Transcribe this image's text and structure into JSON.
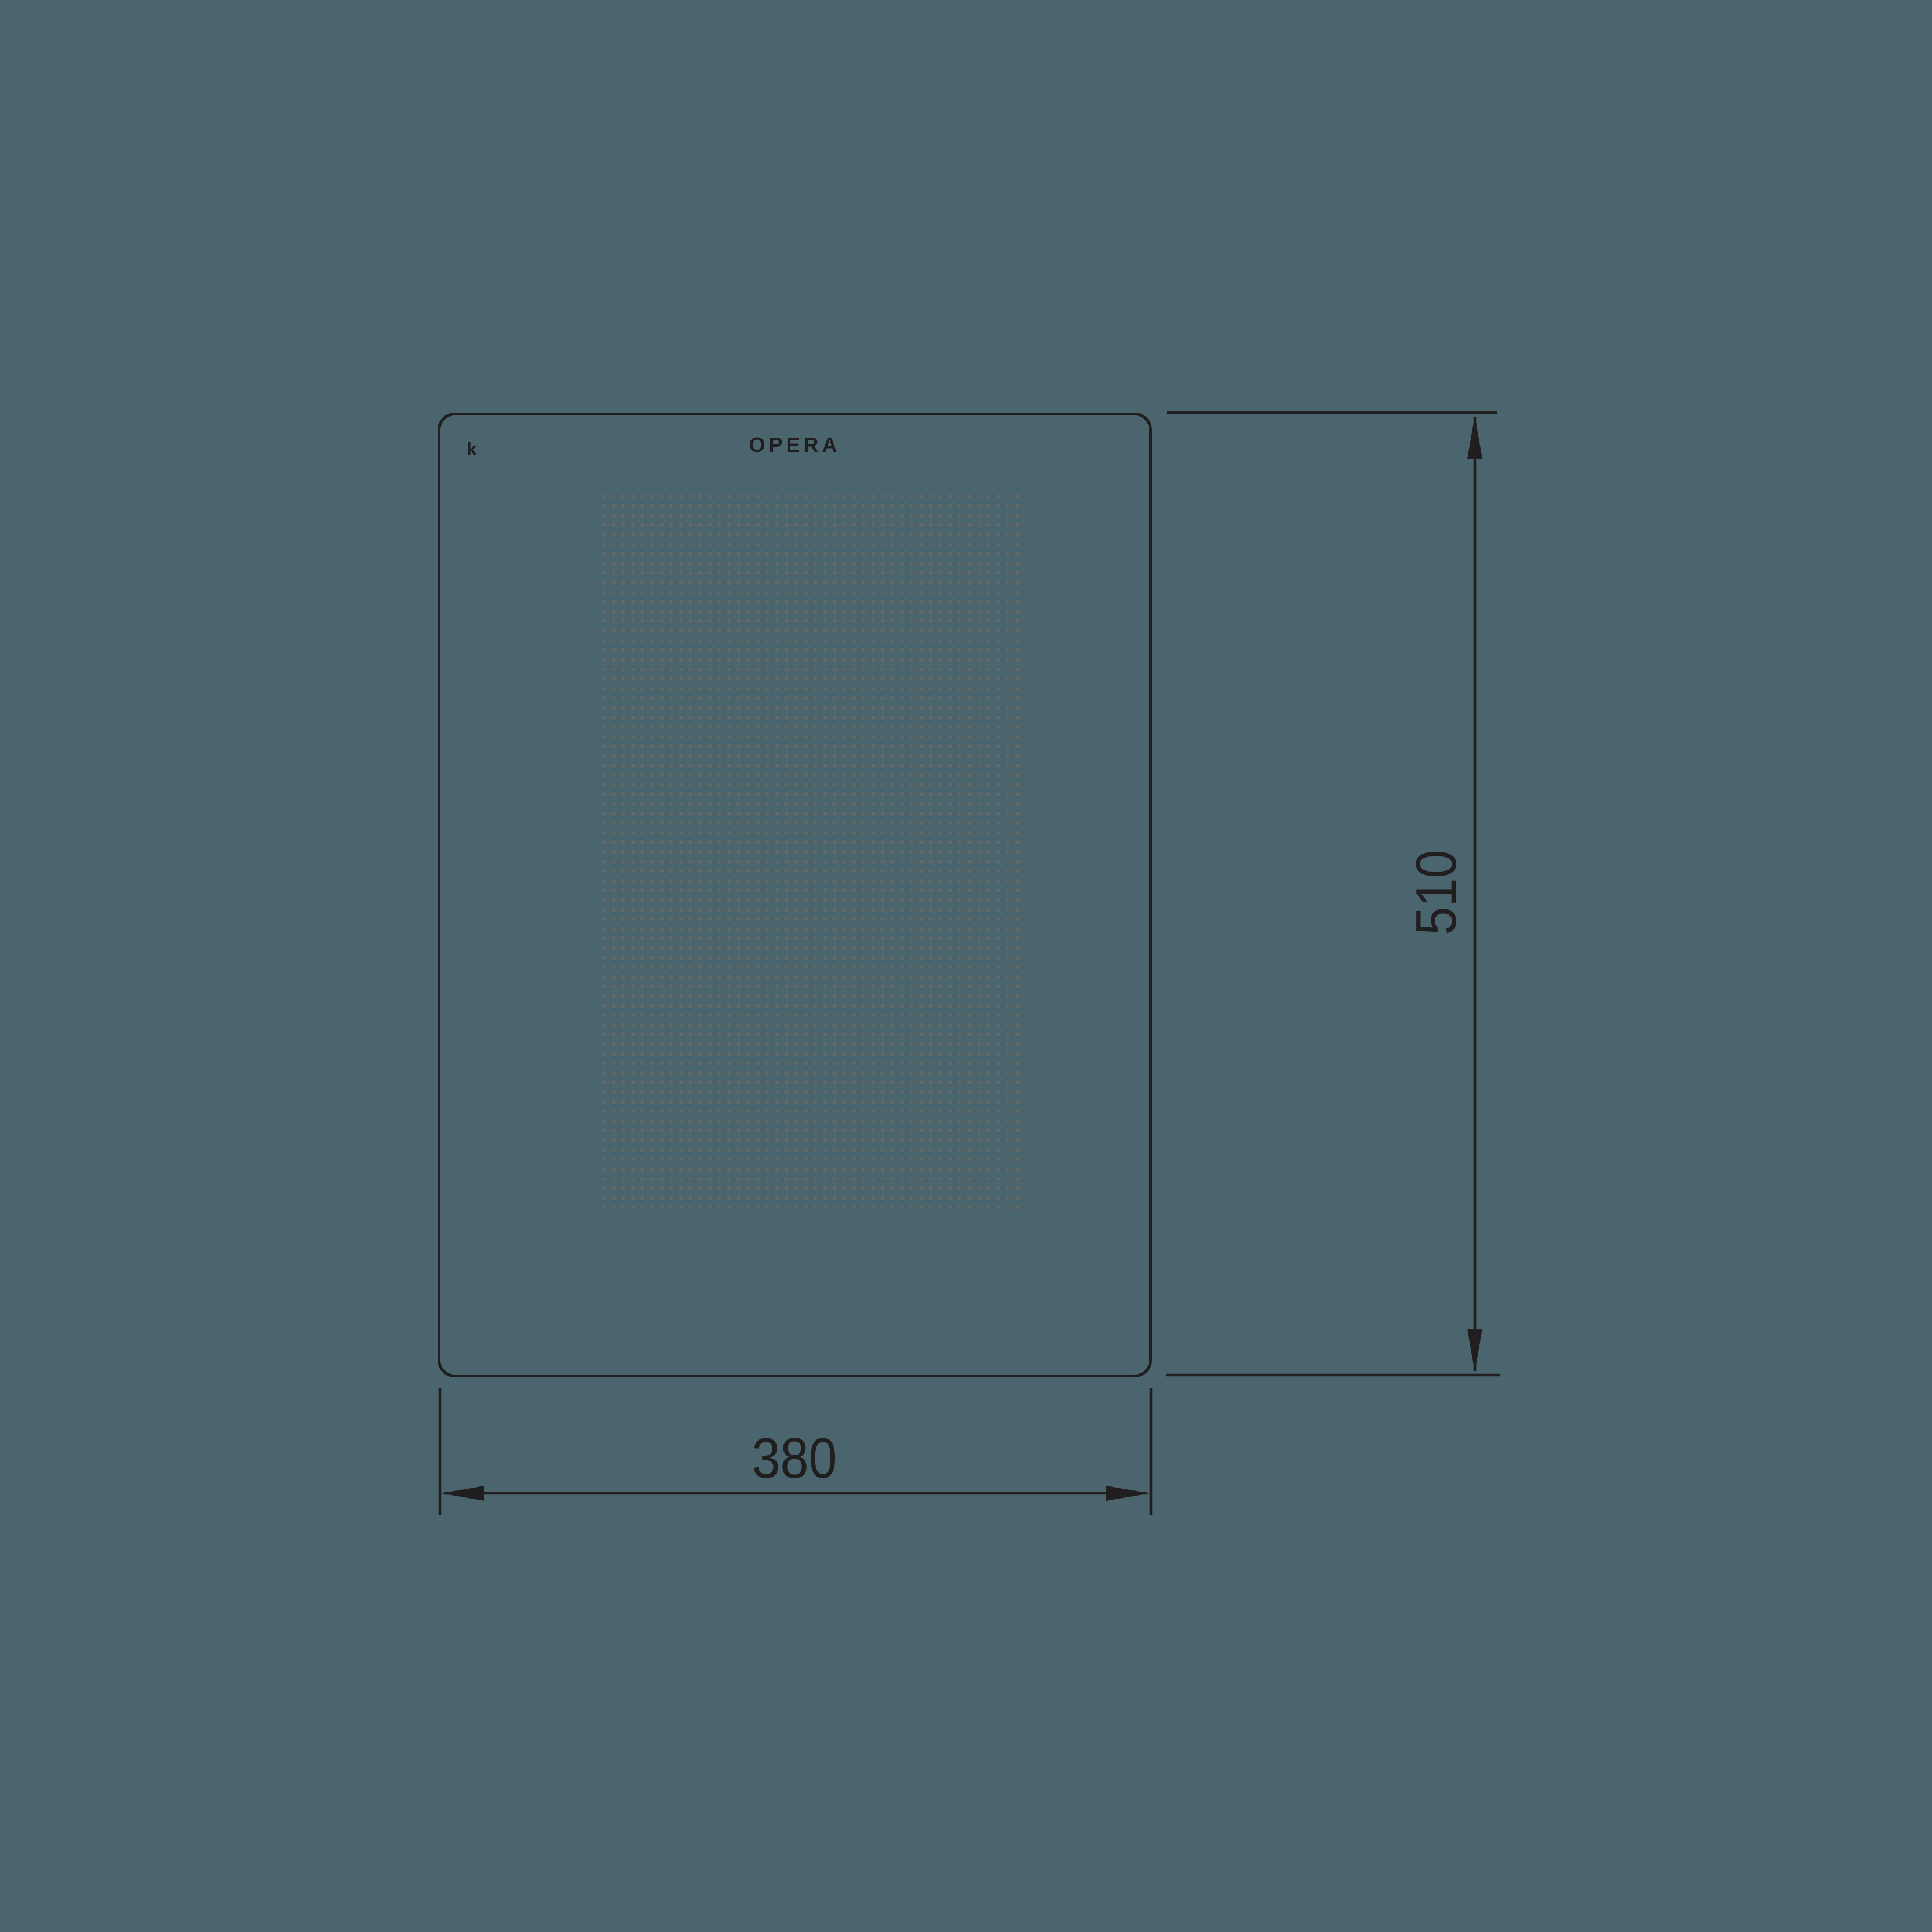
{
  "drawing": {
    "type": "technical-dimension-drawing",
    "subject": "glass front panel",
    "brand_logo": "OPERA",
    "corner_mark": "k",
    "dimensions": {
      "width_label": "380",
      "height_label": "510"
    },
    "colors": {
      "background": "#4b656e",
      "line": "#211e1f",
      "dot": "#6d675f"
    }
  }
}
